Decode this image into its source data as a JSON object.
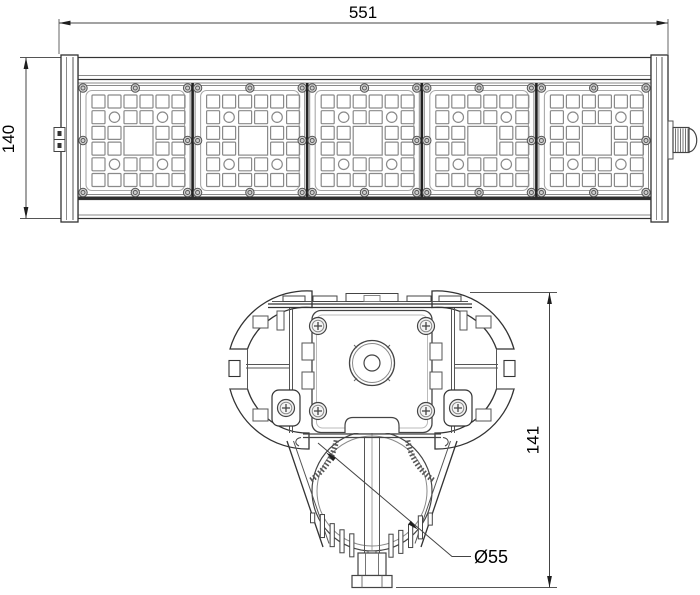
{
  "drawing": {
    "kind": "luminaire-dimension-drawing",
    "colors": {
      "background": "#ffffff",
      "line": "#333333",
      "light_line": "#8a8a8a",
      "divider": "#222222",
      "screw_fill": "#cfcfcf",
      "dim_line": "#444444",
      "text": "#000000"
    },
    "front_view": {
      "dim_width_label": "551",
      "dim_height_label": "140",
      "module_count": 5,
      "grid_cols": 6,
      "grid_rows": 6,
      "screws_per_module": 8
    },
    "section_view": {
      "dim_height_label": "141",
      "pipe_diameter_label": "Ø55",
      "fin_count": 13
    }
  }
}
